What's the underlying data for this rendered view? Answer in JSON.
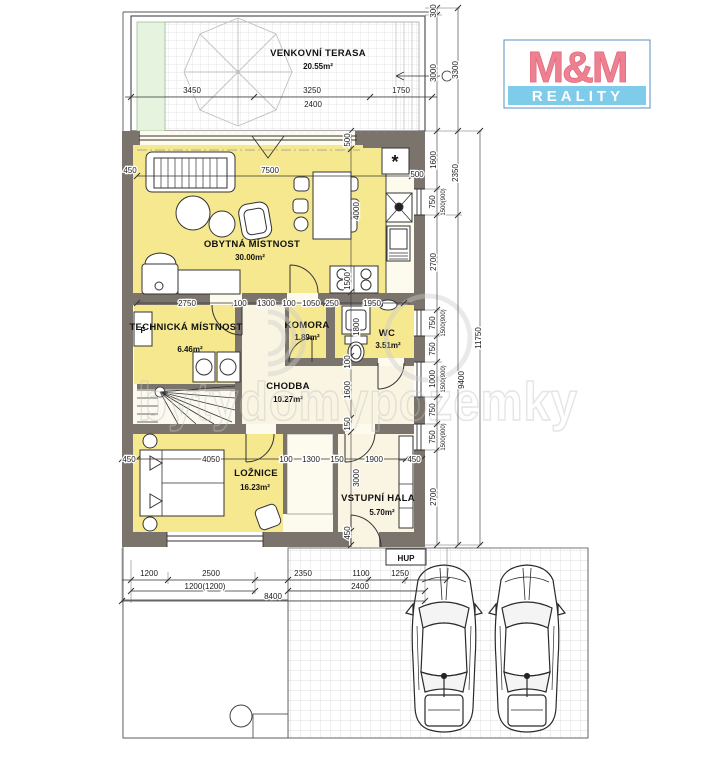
{
  "logo": {
    "top": "M&M",
    "bottom": "REALITY",
    "pink": "#ee8191",
    "blue": "#7fcbea"
  },
  "colors": {
    "wall": "#7b746d",
    "room_yellow": "#f5e88f",
    "room_pale": "#faf5e3",
    "grass": "#e6f3de"
  },
  "watermark": {
    "text": "bytydomypozemky"
  },
  "rooms": {
    "terasa": {
      "name": "VENKOVNÍ TERASA",
      "area": "20.55m²"
    },
    "obytna": {
      "name": "OBYTNÁ MÍSTNOST",
      "area": "30.00m²"
    },
    "technicka": {
      "name": "TECHNICKÁ MÍSTNOST",
      "area": "6.46m²"
    },
    "komora": {
      "name": "KOMORA",
      "area": "1.89m²"
    },
    "wc": {
      "name": "WC",
      "area": "3.51m²"
    },
    "chodba": {
      "name": "CHODBA",
      "area": "10.27m²"
    },
    "loznice": {
      "name": "LOŽNICE",
      "area": "16.23m²"
    },
    "hala": {
      "name": "VSTUPNÍ HALA",
      "area": "5.70m²"
    }
  },
  "labels": {
    "hup": "HUP",
    "boiler": "*",
    "f": "F"
  },
  "dims": {
    "t3450": "3450",
    "t3250": "3250",
    "t2400": "2400",
    "t1750": "1750",
    "r300": "300",
    "r3000": "3000",
    "c3300": "3300",
    "r1600": "1600",
    "r750a": "750",
    "r750a2": "1500(900)",
    "r2700a": "2700",
    "r750b": "750",
    "r750b2": "1500(900)",
    "r750c": "750",
    "r1000": "1000",
    "r1000b": "1500(900)",
    "r750d": "750",
    "r750e": "750",
    "r750e2": "1500(900)",
    "r2700b": "2700",
    "c2350": "2350",
    "c9400": "9400",
    "c11750": "11750",
    "m2750": "2750",
    "m100a": "100",
    "m1300": "1300",
    "m100b": "100",
    "m1050": "1050",
    "m250": "250",
    "m1950": "1950",
    "b450l": "450",
    "b4050": "4050",
    "b100": "100",
    "b1300": "1300",
    "b150": "150",
    "b1900": "1900",
    "b450r": "450",
    "l450a": "450",
    "l450b": "450",
    "k500": "500",
    "lr7500": "7500",
    "i500": "500",
    "i4000": "4000",
    "i1500": "1500",
    "i1800": "1800",
    "i100": "100",
    "i1600": "1600",
    "i150": "150",
    "i3000": "3000",
    "i450": "450",
    "p1200": "1200",
    "p2500": "2500",
    "p1200b": "1200(1200)",
    "p8400": "8400",
    "p2350": "2350",
    "p1100": "1100",
    "p1250": "1250",
    "p2400": "2400"
  }
}
